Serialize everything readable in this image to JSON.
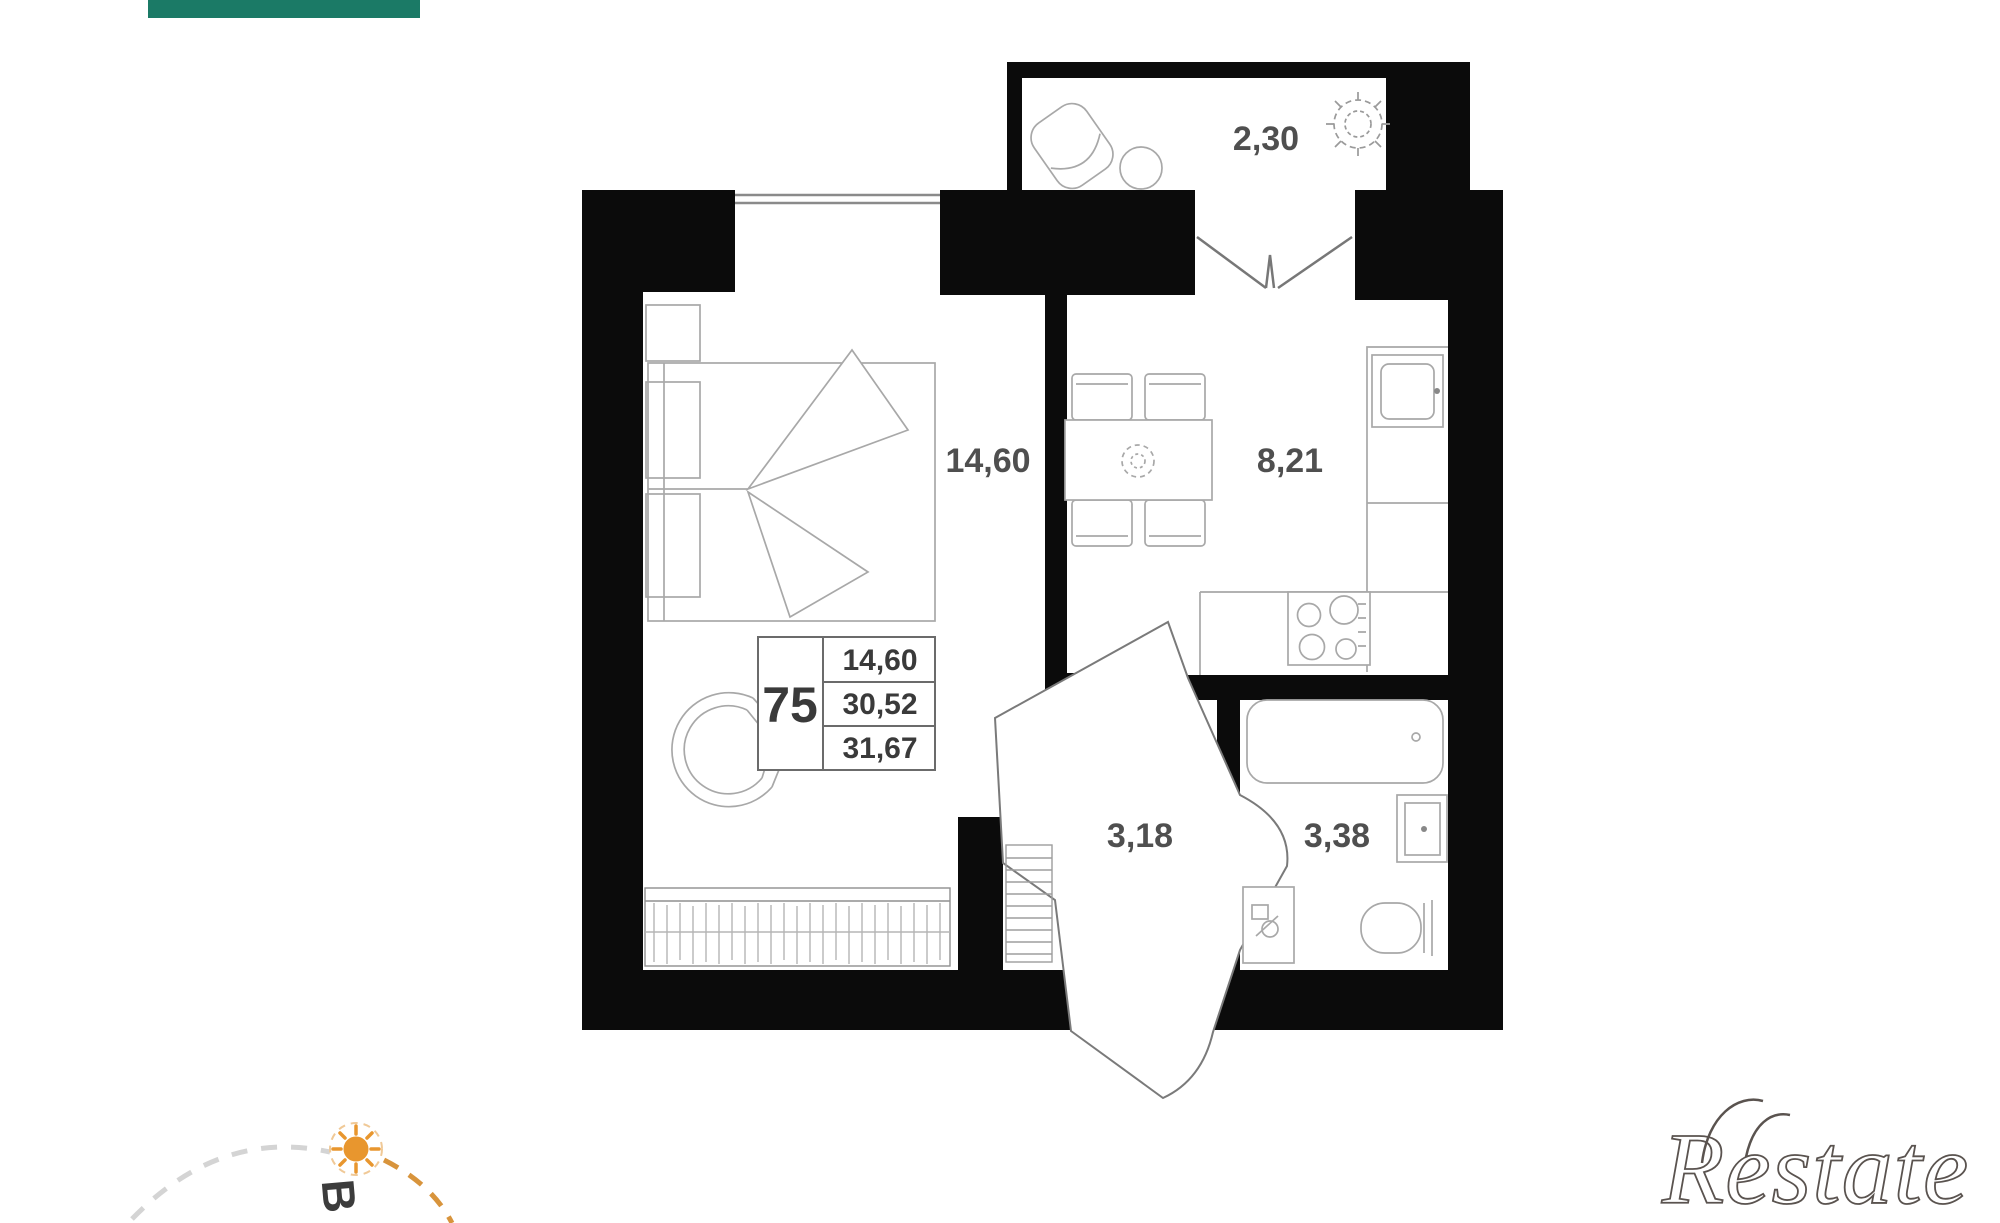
{
  "header": {
    "accent_bar_color": "#1b7a66"
  },
  "floorplan": {
    "wall_color": "#0b0b0b",
    "furniture_line_color": "#a8a8a8",
    "label_color": "#4f4f4f",
    "door_line_color": "#7a7a7a",
    "rooms": [
      {
        "id": "balcony",
        "area_label": "2,30"
      },
      {
        "id": "bedroom",
        "area_label": "14,60"
      },
      {
        "id": "kitchen",
        "area_label": "8,21"
      },
      {
        "id": "hallway",
        "area_label": "3,18"
      },
      {
        "id": "bathroom",
        "area_label": "3,38"
      }
    ],
    "info_table": {
      "apartment_number": "75",
      "rows": [
        "14,60",
        "30,52",
        "31,67"
      ],
      "line_color": "#6b6b6b",
      "number_color": "#3a3a3a"
    }
  },
  "compass": {
    "direction_label": "В",
    "sun_color": "#e8962e",
    "arc_gray": "#d4d4d4",
    "arc_orange": "#d8943c"
  },
  "watermark": {
    "text": "Restate",
    "color": "#5a534f"
  }
}
